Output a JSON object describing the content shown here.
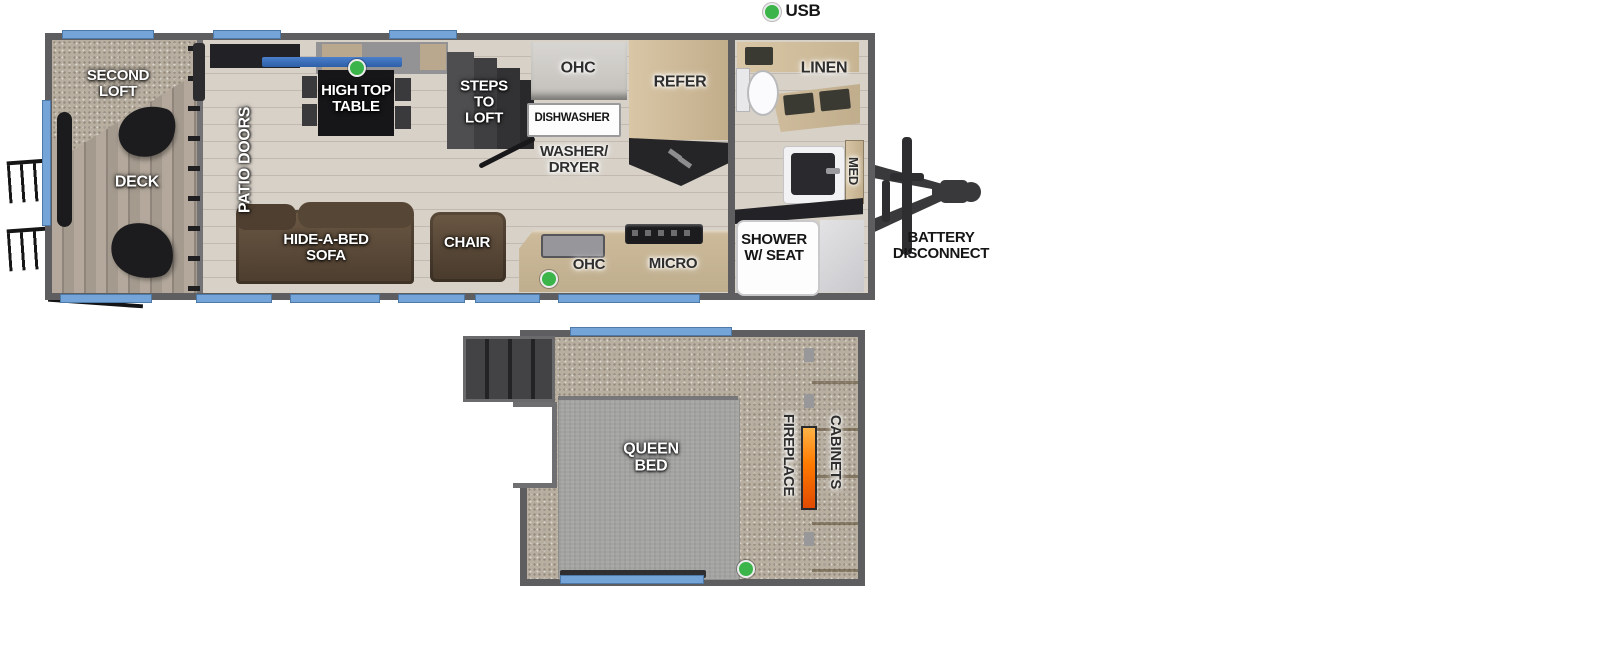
{
  "legend": {
    "usb": "USB",
    "dot_color": "#3bb54a"
  },
  "colors": {
    "wall": "#5e5e60",
    "window_blue": "#74a4d8",
    "usb_green": "#3bb54a",
    "wood_floor": "#d7d1c8",
    "cabinet_wood": "#cdbb9d",
    "counter_dark": "#232327",
    "sofa_brown": "#5a4938",
    "bed_gray": "#a3a3a1",
    "carpet": "#b8afa1",
    "flame_orange": "#ff7a00"
  },
  "upper_floor": {
    "labels": {
      "second_loft": "SECOND\nLOFT",
      "deck": "DECK",
      "patio_doors": "PATIO DOORS",
      "high_top_table": "HIGH TOP\nTABLE",
      "steps_to_loft": "STEPS\nTO\nLOFT",
      "ohc_top": "OHC",
      "dishwasher": "DISHWASHER",
      "washer_dryer": "WASHER/\nDRYER",
      "refer": "REFER",
      "linen": "LINEN",
      "med": "MED",
      "shower": "SHOWER\nW/ SEAT",
      "hide_a_bed_sofa": "HIDE-A-BED\nSOFA",
      "chair": "CHAIR",
      "ohc_bottom": "OHC",
      "micro": "MICRO"
    }
  },
  "exterior": {
    "battery_disconnect": "BATTERY\nDISCONNECT"
  },
  "lower_floor": {
    "labels": {
      "queen_bed": "QUEEN\nBED",
      "fireplace": "FIREPLACE",
      "cabinets": "CABINETS"
    }
  }
}
